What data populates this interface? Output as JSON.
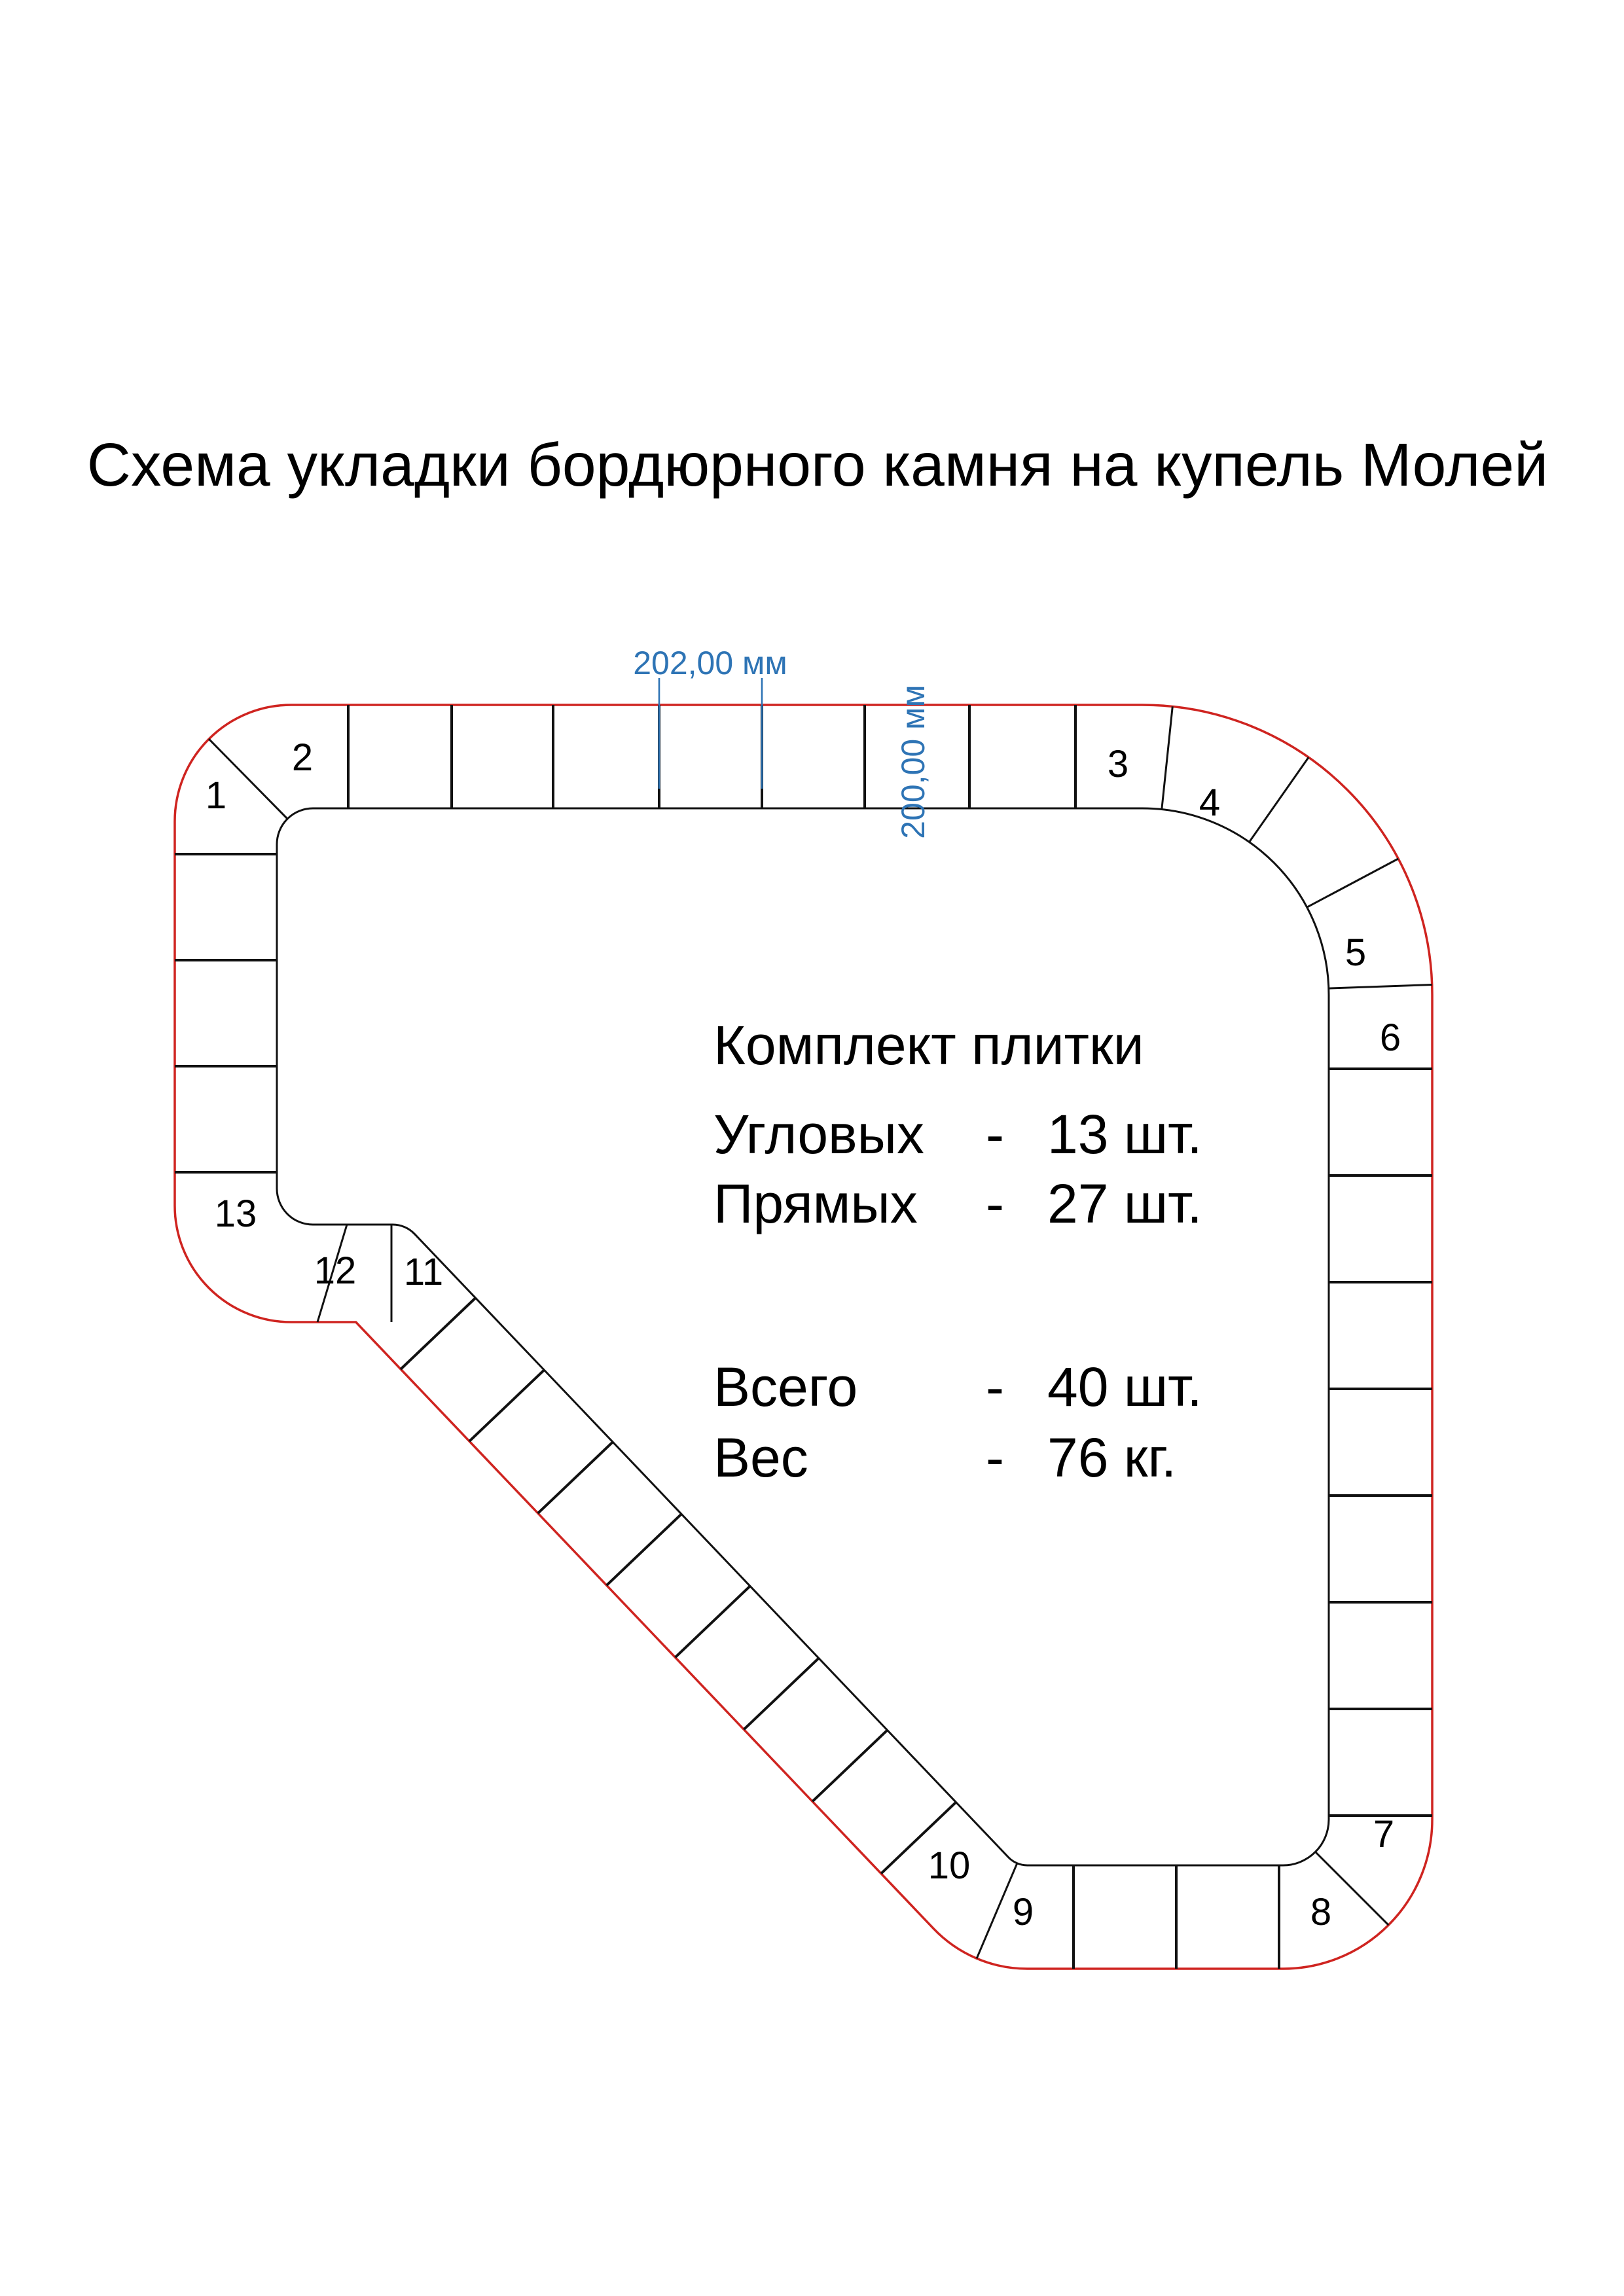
{
  "title": "Схема укладки бордюрного камня на купель Молей",
  "dimensions": {
    "width_label": "202,00 мм",
    "height_label": "200,00 мм",
    "color": "#2e74b5"
  },
  "legend": {
    "heading": "Комплект плитки",
    "rows": [
      {
        "label": "Угловых",
        "dash": "-",
        "value": "13 шт."
      },
      {
        "label": "Прямых",
        "dash": "-",
        "value": "27 шт."
      },
      {
        "label": "Всего",
        "dash": "-",
        "value": "40 шт."
      },
      {
        "label": "Вес",
        "dash": "-",
        "value": "76 кг."
      }
    ]
  },
  "diagram": {
    "outline_color": "#cf2420",
    "line_color": "#111111",
    "corner_tile_numbers": [
      "1",
      "2",
      "3",
      "4",
      "5",
      "6",
      "7",
      "8",
      "9",
      "10",
      "11",
      "12",
      "13"
    ]
  }
}
